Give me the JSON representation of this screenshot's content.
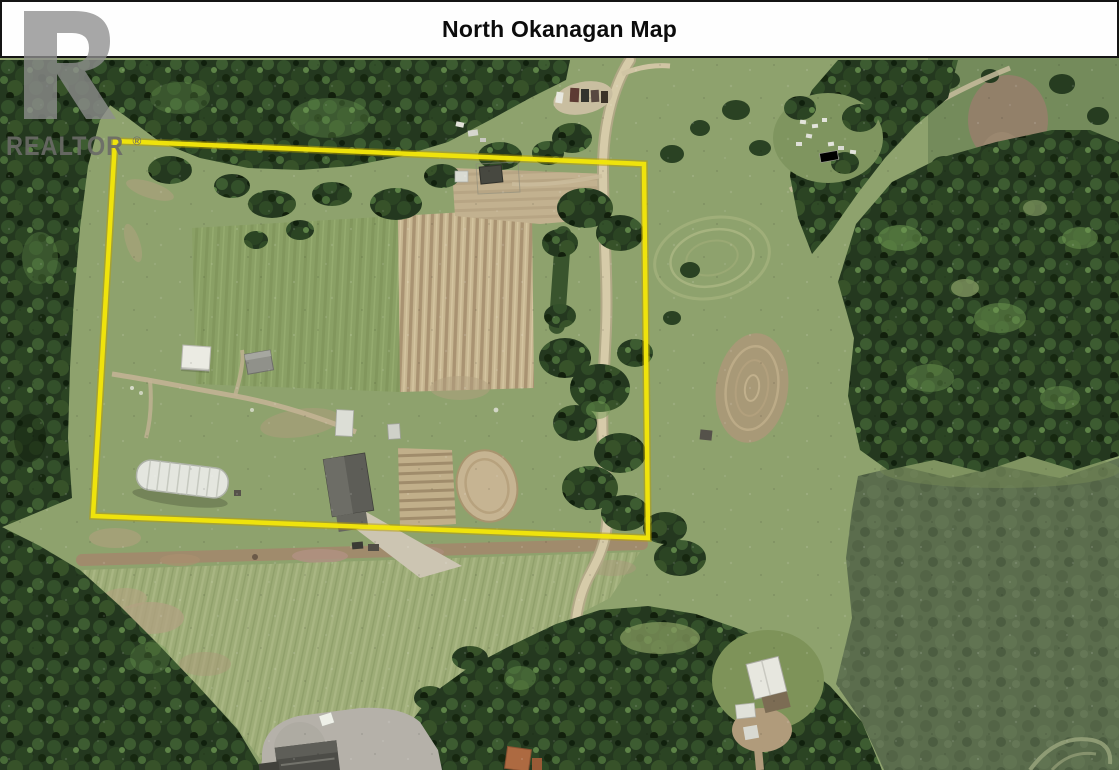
{
  "header": {
    "title": "North Okanagan Map"
  },
  "watermark": {
    "label": "REALTOR",
    "registered": "®"
  },
  "map": {
    "type": "aerial-satellite-photo",
    "region": "North Okanagan",
    "boundary": {
      "color": "#f2e50b",
      "points": "115,83 644,106 648,480 93,458"
    },
    "features": [
      "dense conifer forest",
      "hay field with mowing stripes",
      "market-garden crop rows",
      "hoop greenhouse",
      "barn with gravel driveway",
      "riding ring",
      "farm sheds",
      "beehive boxes",
      "gravel road along east side",
      "cul-de-sac with house",
      "white outbuilding in clearing"
    ]
  },
  "colors": {
    "field_green": "#8ea26d",
    "forest_dark": "#24381f",
    "road_tan": "#d6cba9",
    "boundary_yellow": "#f2e50b",
    "header_text": "#0c0c0c",
    "watermark_gray": "#8e8e8e"
  }
}
